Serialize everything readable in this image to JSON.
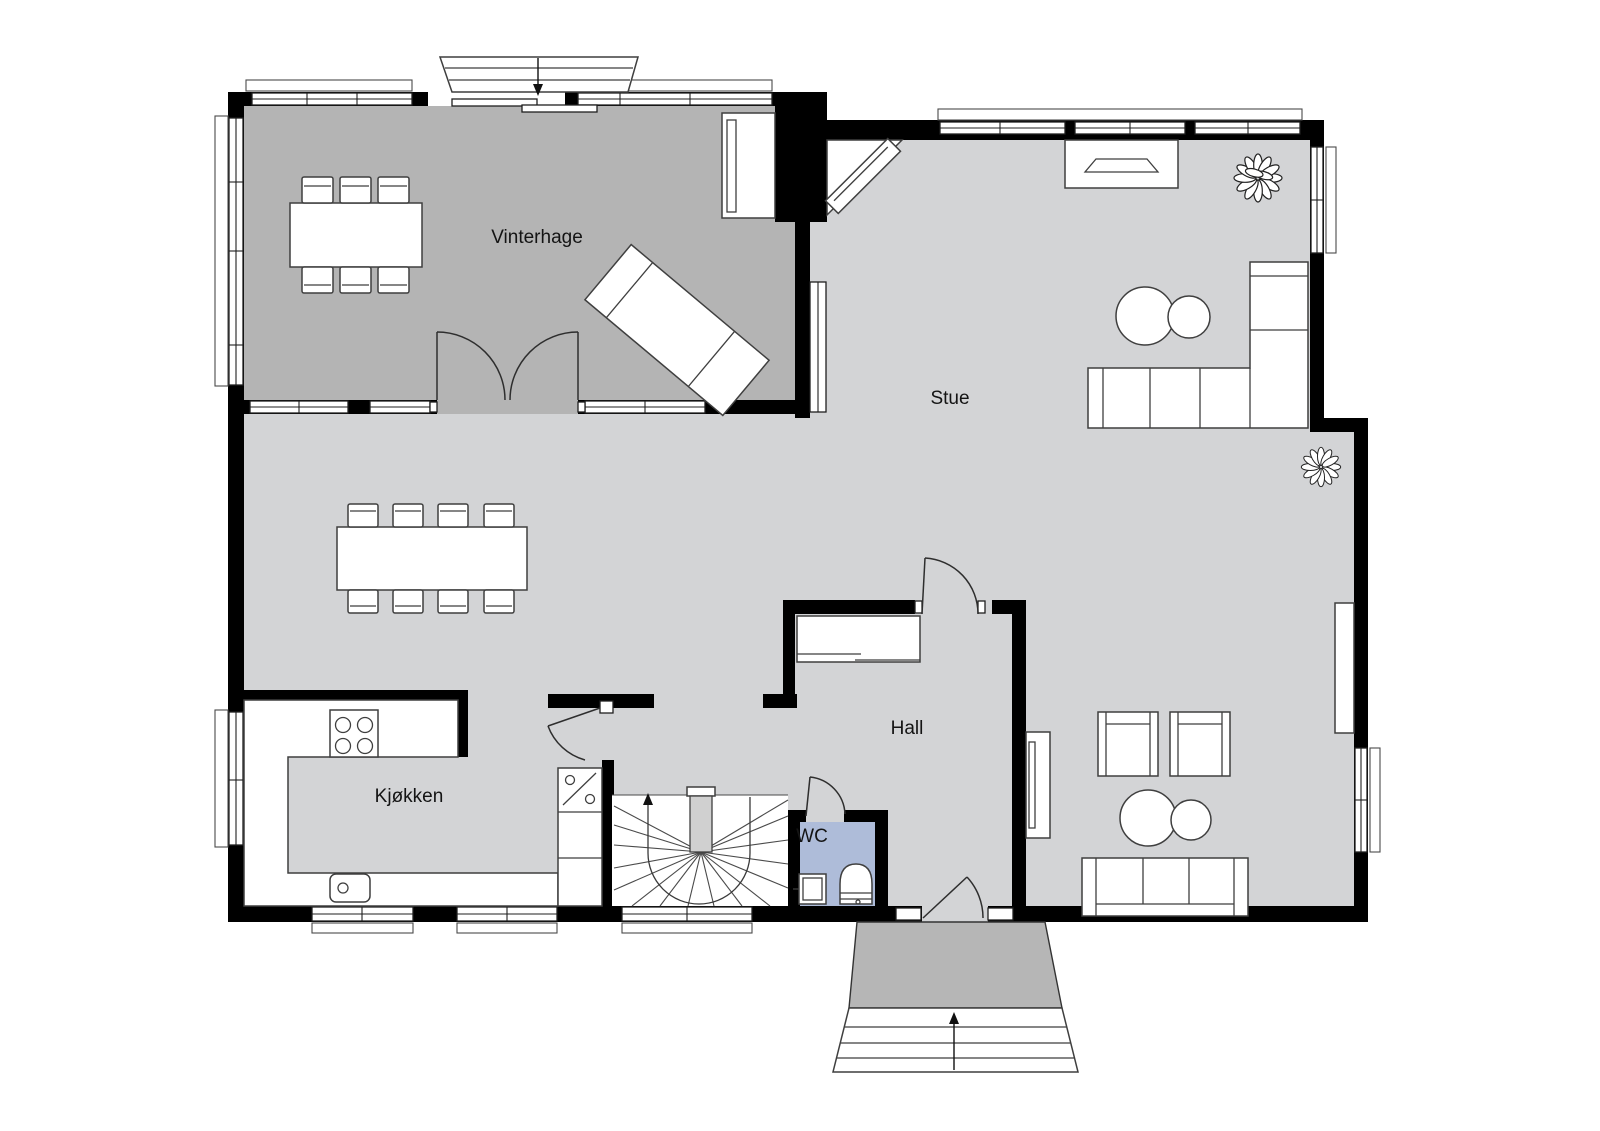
{
  "title": "First floor plan",
  "rooms": {
    "vinterhage": {
      "label": "Vinterhage"
    },
    "stue": {
      "label": "Stue"
    },
    "hall": {
      "label": "Hall"
    },
    "kjokken": {
      "label": "Kjøkken"
    },
    "wc": {
      "label": "WC"
    }
  },
  "colors": {
    "background": "#ffffff",
    "wall": "#000000",
    "floor_main": "#d3d4d6",
    "floor_vinterhage": "#b4b4b4",
    "floor_wc": "#aebcd9",
    "floor_entrance": "#b6b6b6",
    "newel": "#d0d0d0",
    "furniture_fill": "#ffffff",
    "furniture_stroke": "#3f3f3f"
  },
  "icons": {
    "entrance_arrow_down": "▼",
    "entrance_arrow_up": "▲",
    "stairs_direction_arrow": "↑",
    "dishwasher_symbol": "%",
    "plant": "✿"
  }
}
